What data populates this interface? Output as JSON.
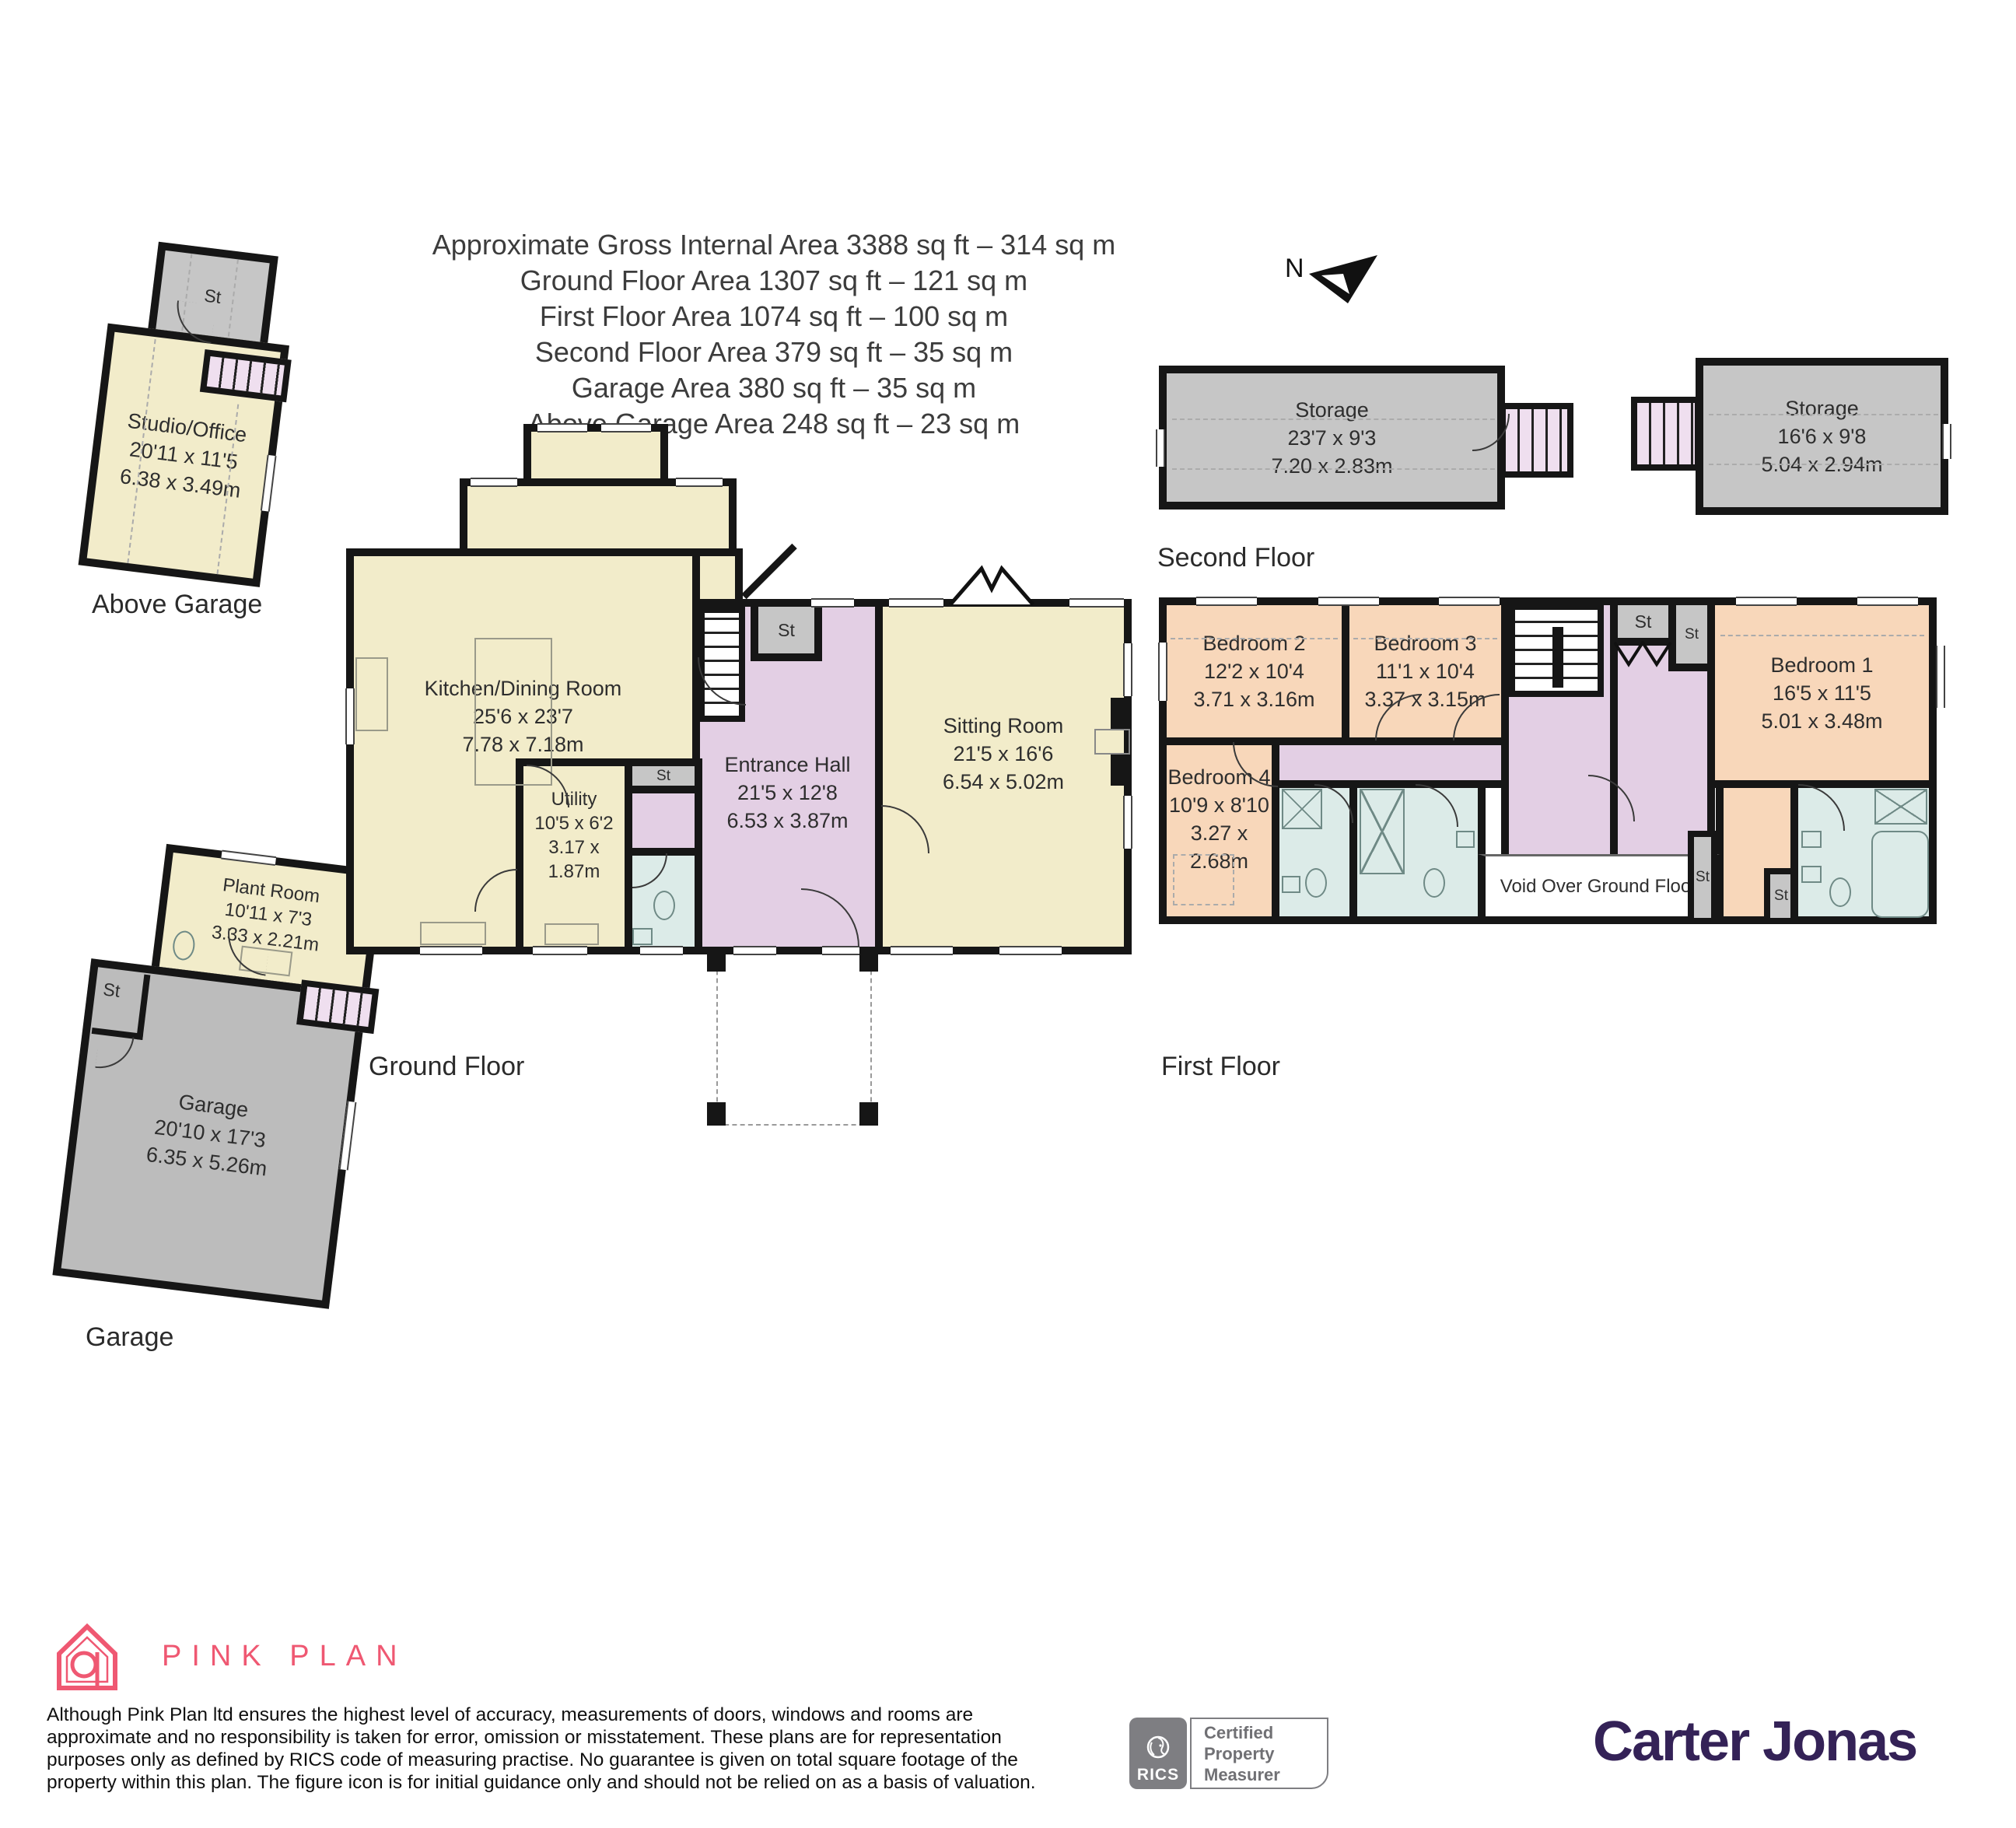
{
  "header": {
    "lines": [
      "Approximate Gross Internal Area 3388 sq ft – 314 sq m",
      "Ground Floor Area 1307 sq ft – 121 sq m",
      "First Floor Area 1074 sq ft – 100 sq m",
      "Second Floor Area 379 sq ft – 35 sq m",
      "Garage Area 380 sq ft – 35 sq m",
      "Above Garage Area 248 sq ft – 23 sq m"
    ]
  },
  "compass": {
    "label": "N"
  },
  "plans": {
    "above_garage": {
      "label": "Above Garage",
      "st": "St",
      "studio": {
        "name": "Studio/Office",
        "ft": "20'11 x 11'5",
        "m": "6.38 x 3.49m"
      }
    },
    "second_floor": {
      "label": "Second Floor",
      "storage_left": {
        "name": "Storage",
        "ft": "23'7 x 9'3",
        "m": "7.20 x 2.83m"
      },
      "storage_right": {
        "name": "Storage",
        "ft": "16'6 x 9'8",
        "m": "5.04 x 2.94m"
      }
    },
    "ground_floor": {
      "label": "Ground Floor",
      "st": "St",
      "kitchen": {
        "name": "Kitchen/Dining Room",
        "ft": "25'6 x 23'7",
        "m": "7.78 x 7.18m"
      },
      "utility": {
        "name": "Utility",
        "ft": "10'5 x 6'2",
        "m": "3.17 x 1.87m"
      },
      "entrance": {
        "name": "Entrance Hall",
        "ft": "21'5 x 12'8",
        "m": "6.53 x 3.87m"
      },
      "sitting": {
        "name": "Sitting Room",
        "ft": "21'5 x 16'6",
        "m": "6.54 x 5.02m"
      }
    },
    "first_floor": {
      "label": "First Floor",
      "st": "St",
      "void": "Void Over Ground Floor",
      "bedroom1": {
        "name": "Bedroom 1",
        "ft": "16'5 x 11'5",
        "m": "5.01 x 3.48m"
      },
      "bedroom2": {
        "name": "Bedroom 2",
        "ft": "12'2 x 10'4",
        "m": "3.71 x 3.16m"
      },
      "bedroom3": {
        "name": "Bedroom 3",
        "ft": "11'1 x 10'4",
        "m": "3.37 x 3.15m"
      },
      "bedroom4": {
        "name": "Bedroom 4",
        "ft": "10'9 x 8'10",
        "m": "3.27 x 2.68m"
      }
    },
    "garage": {
      "label": "Garage",
      "st": "St",
      "plant": {
        "name": "Plant Room",
        "ft": "10'11 x 7'3",
        "m": "3.33 x 2.21m"
      },
      "garage_room": {
        "name": "Garage",
        "ft": "20'10 x 17'3",
        "m": "6.35 x 5.26m"
      }
    }
  },
  "footer": {
    "brand": "PINK PLAN",
    "disclaimer_lines": [
      "Although Pink Plan ltd ensures the highest level of accuracy, measurements of doors, windows and rooms are",
      "approximate and no responsibility is taken for error, omission or misstatement. These plans are for representation",
      "purposes only as defined by RICS code of measuring practise. No guarantee is given on total square footage of the",
      "property within this plan. The figure icon is for initial guidance only and should not be relied on as a basis of valuation."
    ],
    "rics": {
      "name": "RICS",
      "cert_lines": [
        "Certified",
        "Property",
        "Measurer"
      ]
    },
    "agent": "Carter Jonas"
  },
  "colors": {
    "room_cream": "#f2ecca",
    "room_peach": "#f8d7ba",
    "room_lavender": "#e3cfe4",
    "room_blue": "#dcebe8",
    "room_gray": "#c6c6c6",
    "garage_gray": "#bcbcbc",
    "stairs_pink": "#efdfef",
    "wall": "#161616",
    "brand_pink": "#ef5872",
    "agent_purple": "#342257",
    "rics_gray": "#7e7e82"
  }
}
